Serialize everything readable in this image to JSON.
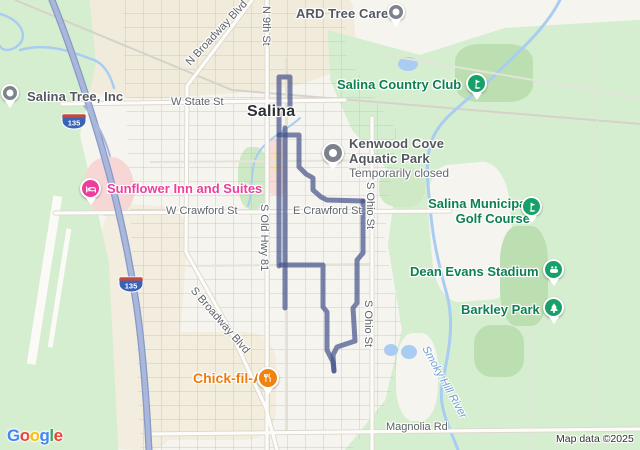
{
  "colors": {
    "route": "#46548A",
    "park_green": "#d5eecf",
    "tree_green": "#bcdfb2",
    "water": "#a9cdf2",
    "highway": "#aab6da",
    "poi_green_text": "#0d8050",
    "poi_gray_text": "#54585e",
    "pin_green": "#17a168",
    "pin_pink": "#ee3d9c",
    "pin_orange": "#f0820f"
  },
  "city": {
    "label": "Salina"
  },
  "pois": {
    "salina_tree": {
      "label": "Salina Tree, Inc"
    },
    "ard": {
      "label": "ARD Tree Care"
    },
    "country_club": {
      "label": "Salina Country Club"
    },
    "kenwood": {
      "line1": "Kenwood Cove",
      "line2": "Aquatic Park",
      "status": "Temporarily closed"
    },
    "sunflower": {
      "label": "Sunflower Inn and Suites"
    },
    "golf": {
      "line1": "Salina Municipal",
      "line2": "Golf Course"
    },
    "dean_evans": {
      "label": "Dean Evans Stadium"
    },
    "barkley": {
      "label": "Barkley Park"
    },
    "chickfila": {
      "label": "Chick-fil-A"
    }
  },
  "streets": {
    "w_state": "W State St",
    "n_broadway": "N Broadway Blvd",
    "n_9th": "N 9th St",
    "w_crawford": "W Crawford St",
    "e_crawford": "E Crawford St",
    "s_old_hwy": "S Old Hwy 81",
    "s_ohio": "S Ohio St",
    "s_broadway": "S Broadway Blvd",
    "magnolia": "Magnolia Rd",
    "smoky_hill": "Smoky Hill River"
  },
  "highway_shield": {
    "number": "135"
  },
  "footer": {
    "logo_letters": [
      "G",
      "o",
      "o",
      "g",
      "l",
      "e"
    ],
    "logo": "Google",
    "attribution": "Map data ©2025"
  }
}
